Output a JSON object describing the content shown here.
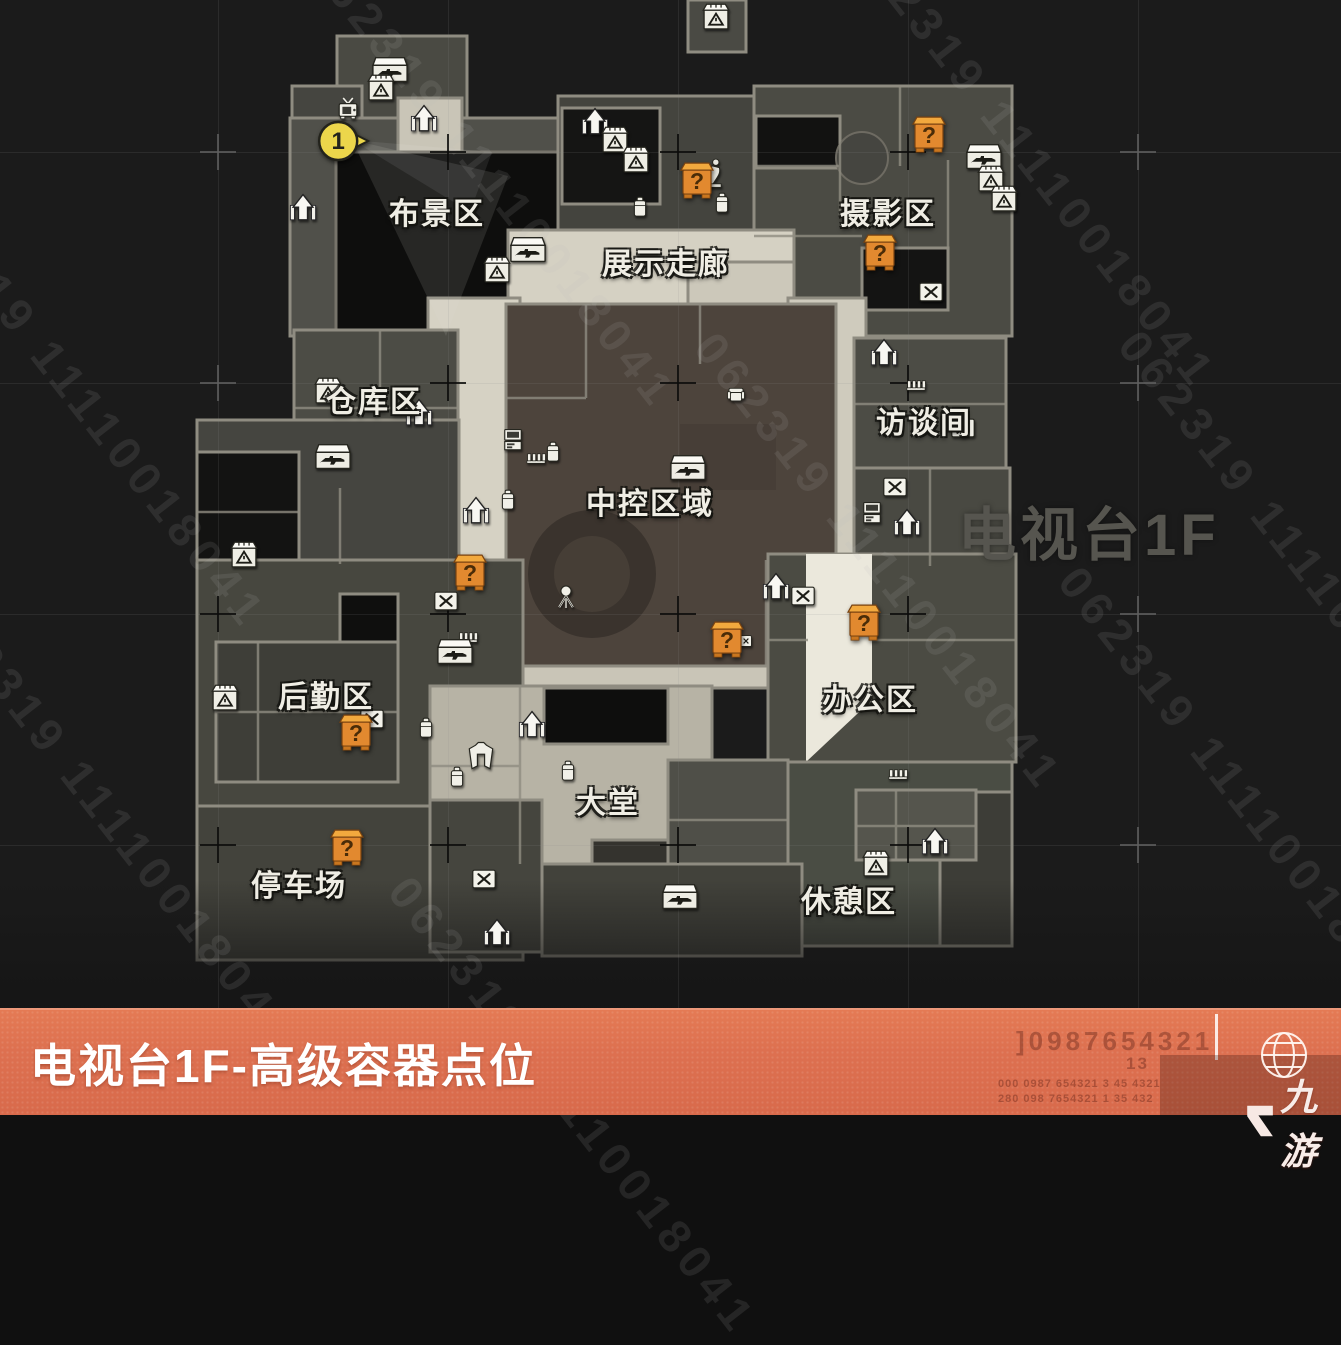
{
  "watermark": {
    "text": "062319 11110018041",
    "instances": [
      [
        340,
        -60
      ],
      [
        -70,
        160
      ],
      [
        -40,
        580
      ],
      [
        880,
        -80
      ],
      [
        726,
        322
      ],
      [
        1090,
        556
      ],
      [
        420,
        866
      ],
      [
        1150,
        320
      ]
    ],
    "map_label": "电视台1F"
  },
  "map": {
    "regions": [
      {
        "label": "布景区",
        "x": 437,
        "y": 211
      },
      {
        "label": "摄影区",
        "x": 888,
        "y": 211
      },
      {
        "label": "展示走廊",
        "x": 666,
        "y": 261
      },
      {
        "label": "仓库区",
        "x": 374,
        "y": 399
      },
      {
        "label": "访谈间",
        "x": 924,
        "y": 420
      },
      {
        "label": "中控区域",
        "x": 650,
        "y": 501
      },
      {
        "label": "后勤区",
        "x": 326,
        "y": 694
      },
      {
        "label": "办公区",
        "x": 870,
        "y": 697
      },
      {
        "label": "大堂",
        "x": 608,
        "y": 800
      },
      {
        "label": "停车场",
        "x": 299,
        "y": 883
      },
      {
        "label": "休憩区",
        "x": 849,
        "y": 899
      }
    ],
    "question_markers": {
      "symbol": "?",
      "color": "#e2892f",
      "positions": [
        [
          929,
          140
        ],
        [
          697,
          186
        ],
        [
          880,
          258
        ],
        [
          470,
          578
        ],
        [
          727,
          645
        ],
        [
          864,
          628
        ],
        [
          356,
          738
        ],
        [
          347,
          853
        ]
      ]
    },
    "numbered_marker": {
      "label": "1",
      "x": 338,
      "y": 141,
      "color": "#ecd64b"
    },
    "icons": [
      {
        "type": "case-rifle",
        "x": 390,
        "y": 70
      },
      {
        "type": "case-ammo",
        "x": 381,
        "y": 88
      },
      {
        "type": "tv",
        "x": 348,
        "y": 110
      },
      {
        "type": "stairs",
        "x": 424,
        "y": 120
      },
      {
        "type": "stairs",
        "x": 303,
        "y": 209
      },
      {
        "type": "stairs",
        "x": 595,
        "y": 123
      },
      {
        "type": "case-ammo",
        "x": 615,
        "y": 140
      },
      {
        "type": "case-ammo",
        "x": 636,
        "y": 160
      },
      {
        "type": "luggage",
        "x": 640,
        "y": 207
      },
      {
        "type": "statue",
        "x": 714,
        "y": 173
      },
      {
        "type": "luggage",
        "x": 722,
        "y": 203
      },
      {
        "type": "case-ammo",
        "x": 716,
        "y": 17
      },
      {
        "type": "case-rifle",
        "x": 984,
        "y": 157
      },
      {
        "type": "case-ammo",
        "x": 991,
        "y": 179
      },
      {
        "type": "case-ammo",
        "x": 1004,
        "y": 199
      },
      {
        "type": "case-tool",
        "x": 931,
        "y": 292
      },
      {
        "type": "case-rifle",
        "x": 528,
        "y": 250
      },
      {
        "type": "case-ammo",
        "x": 497,
        "y": 270
      },
      {
        "type": "case-ammo",
        "x": 328,
        "y": 391
      },
      {
        "type": "stairs",
        "x": 419,
        "y": 414
      },
      {
        "type": "case-rifle",
        "x": 333,
        "y": 457
      },
      {
        "type": "stairs",
        "x": 476,
        "y": 512
      },
      {
        "type": "computer",
        "x": 513,
        "y": 440
      },
      {
        "type": "fence",
        "x": 536,
        "y": 458
      },
      {
        "type": "luggage",
        "x": 553,
        "y": 452
      },
      {
        "type": "luggage",
        "x": 508,
        "y": 500
      },
      {
        "type": "chair",
        "x": 736,
        "y": 396
      },
      {
        "type": "case-rifle",
        "x": 688,
        "y": 468
      },
      {
        "type": "stairs",
        "x": 884,
        "y": 354
      },
      {
        "type": "fence",
        "x": 916,
        "y": 385
      },
      {
        "type": "case-tool",
        "x": 963,
        "y": 428
      },
      {
        "type": "case-tool",
        "x": 895,
        "y": 487
      },
      {
        "type": "computer",
        "x": 872,
        "y": 513
      },
      {
        "type": "stairs",
        "x": 907,
        "y": 524
      },
      {
        "type": "mic",
        "x": 566,
        "y": 597
      },
      {
        "type": "case-tool",
        "x": 446,
        "y": 601
      },
      {
        "type": "fence",
        "x": 468,
        "y": 637
      },
      {
        "type": "case-rifle",
        "x": 455,
        "y": 652
      },
      {
        "type": "case-ammo",
        "x": 244,
        "y": 555
      },
      {
        "type": "case-ammo",
        "x": 225,
        "y": 698
      },
      {
        "type": "case-tool",
        "x": 372,
        "y": 719
      },
      {
        "type": "luggage",
        "x": 426,
        "y": 728
      },
      {
        "type": "stairs",
        "x": 532,
        "y": 726
      },
      {
        "type": "luggage",
        "x": 457,
        "y": 777
      },
      {
        "type": "jacket",
        "x": 481,
        "y": 756
      },
      {
        "type": "luggage",
        "x": 568,
        "y": 771
      },
      {
        "type": "stairs",
        "x": 776,
        "y": 588
      },
      {
        "type": "case-tool",
        "x": 803,
        "y": 596
      },
      {
        "type": "device",
        "x": 746,
        "y": 641
      },
      {
        "type": "fence",
        "x": 898,
        "y": 774
      },
      {
        "type": "stairs",
        "x": 935,
        "y": 843
      },
      {
        "type": "case-ammo",
        "x": 876,
        "y": 864
      },
      {
        "type": "case-rifle",
        "x": 680,
        "y": 897
      },
      {
        "type": "case-tool",
        "x": 484,
        "y": 879
      },
      {
        "type": "stairs",
        "x": 497,
        "y": 934
      }
    ],
    "grid": {
      "xs": [
        218,
        448,
        678,
        908,
        1138
      ],
      "ys": [
        152,
        383,
        614,
        845
      ],
      "dark_crosses": [
        [
          448,
          152
        ],
        [
          678,
          152
        ],
        [
          908,
          152
        ],
        [
          448,
          383
        ],
        [
          678,
          383
        ],
        [
          908,
          383
        ],
        [
          218,
          614
        ],
        [
          448,
          614
        ],
        [
          678,
          614
        ],
        [
          908,
          614
        ],
        [
          218,
          845
        ],
        [
          448,
          845
        ],
        [
          678,
          845
        ],
        [
          908,
          845
        ]
      ],
      "light_crosses": [
        [
          218,
          152
        ],
        [
          1138,
          152
        ],
        [
          218,
          383
        ],
        [
          1138,
          383
        ],
        [
          1138,
          614
        ],
        [
          1138,
          845
        ]
      ]
    }
  },
  "footer": {
    "title": "电视台1F-高级容器点位",
    "bar_color": "#dd7050",
    "ghost_big": "]0987654321",
    "ghost_mid": "13",
    "ghost_small_1": "000 0987 654321 3 45 4321",
    "ghost_small_2": "280 098 7654321 1 35 432",
    "logo_text": "九游"
  }
}
